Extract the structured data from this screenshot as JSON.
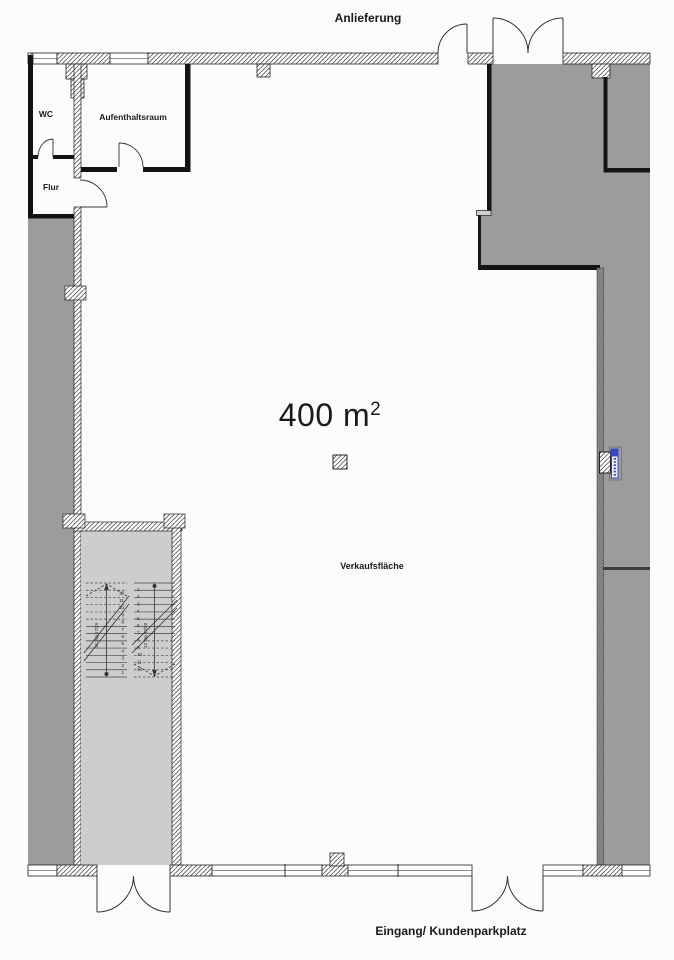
{
  "plan": {
    "labels": {
      "top_entrance": "Anlieferung",
      "bottom_entrance": "Eingang/ Kundenparkplatz",
      "area_value": "400 m",
      "area_superscript": "2",
      "sales_area": "Verkaufsfläche",
      "wc": "WC",
      "break_room": "Aufenthaltsraum",
      "hallway": "Flur"
    },
    "stairs": {
      "flights": 2,
      "steps_per_flight": 12,
      "step_numbers": [
        1,
        2,
        3,
        4,
        5,
        6,
        7,
        8,
        9,
        10,
        11,
        12
      ],
      "annotation": "12 Stg 17/29"
    },
    "colors": {
      "shaded_area": "#9c9c9c",
      "stairwell_floor": "#cdcdcd",
      "wall_black": "#141414",
      "marker_blue": "#3847c4"
    }
  }
}
